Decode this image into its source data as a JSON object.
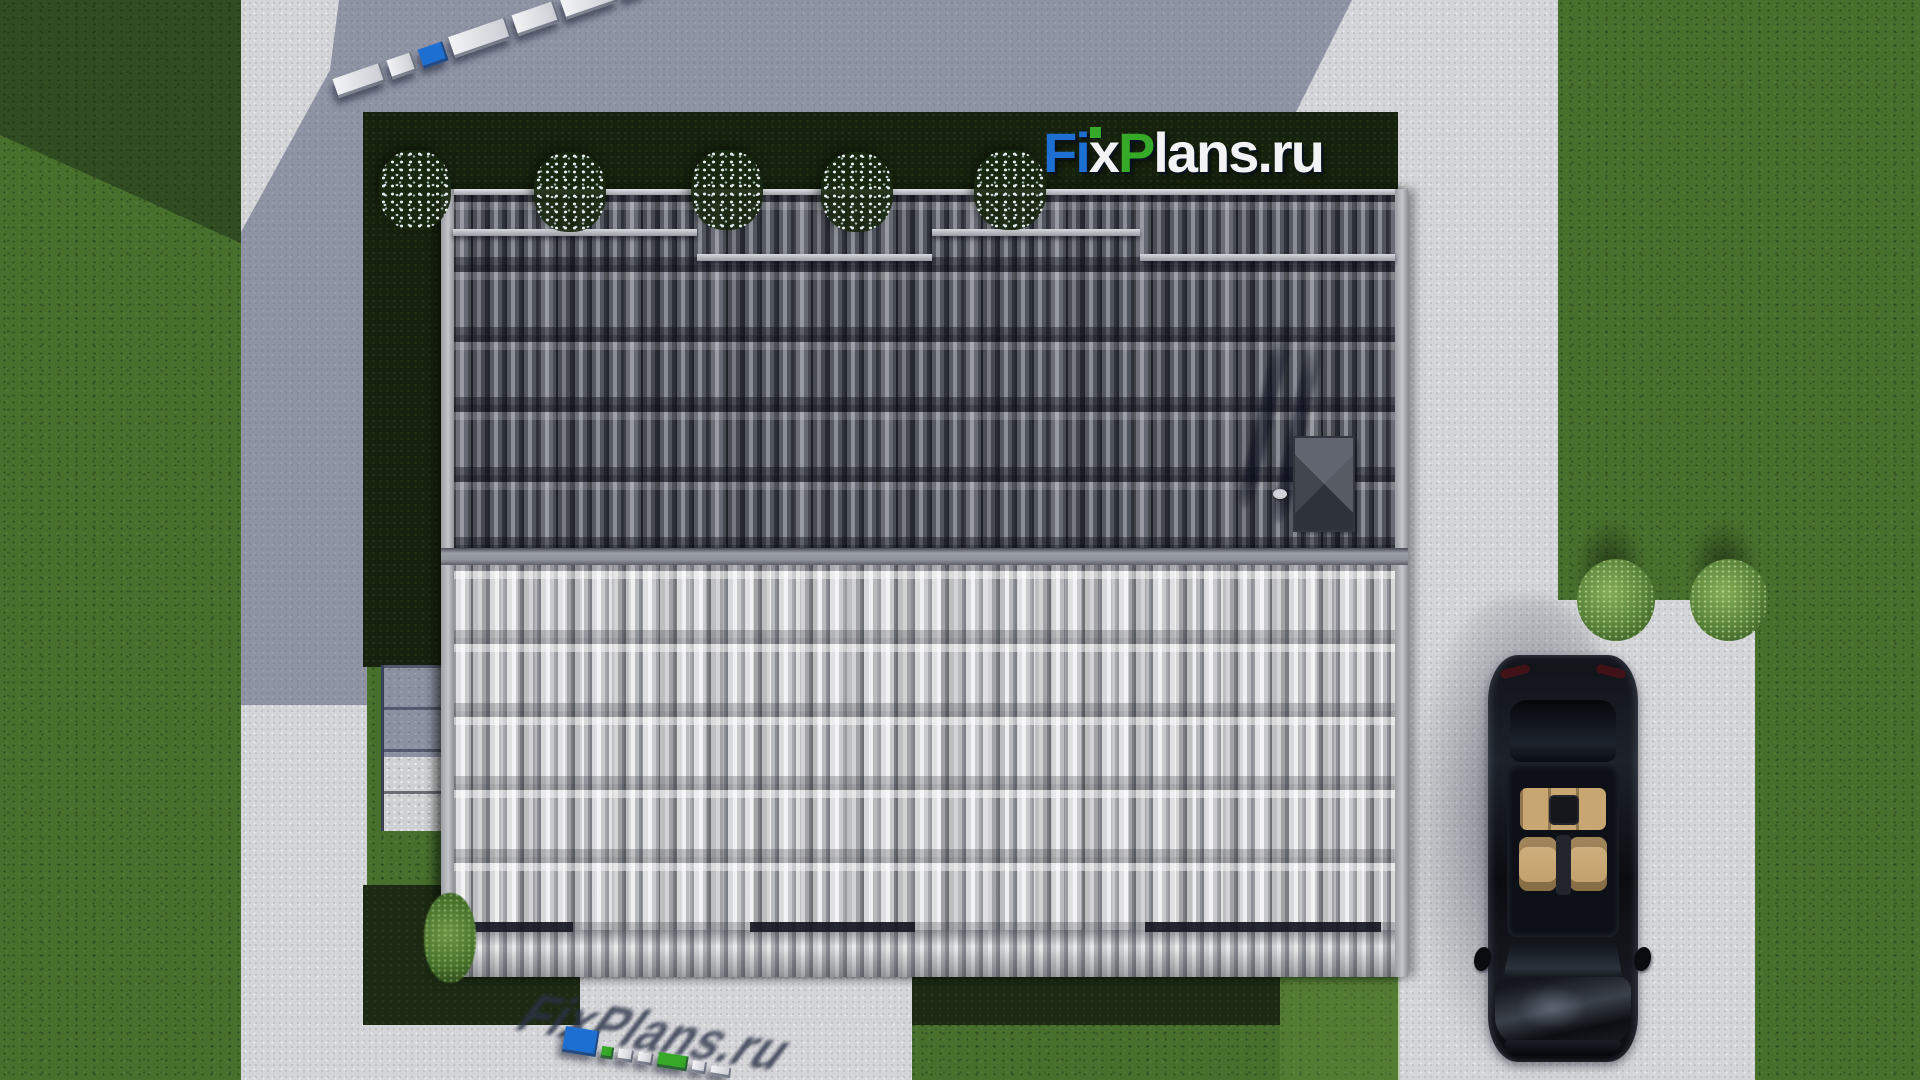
{
  "site": {
    "brand": "FixPlans.ru"
  },
  "logo": {
    "segments": [
      {
        "text": "F",
        "color": "#1e6fd2"
      },
      {
        "text": "i",
        "color": "#1e6fd2"
      },
      {
        "text": "x",
        "color": "#f2f3f5"
      },
      {
        "text": "P",
        "color": "#36a928"
      },
      {
        "text": "lans",
        "color": "#f2f3f5"
      },
      {
        "text": ".ru",
        "color": "#f2f3f5"
      }
    ],
    "i_dot_color": "#36a928"
  },
  "palette": {
    "grass": "#47702d",
    "concrete": "#d4d5d8",
    "concrete_shadow": "rgba(58,68,102,0.45)",
    "hedge": "#17220e",
    "roof_dark": "#4a4e57",
    "roof_light": "#cdced2",
    "ridge": "#8f9399",
    "fascia": "#b2b5ba",
    "car": "#0c0e12",
    "car_interior": "#c9a872",
    "logo_blue": "#1e6fd2",
    "logo_green": "#36a928",
    "logo_white": "#f2f3f5"
  },
  "watermarks": {
    "top_strip": {
      "angle_deg": -19,
      "blocks": [
        {
          "c": "white",
          "w": 50,
          "h": 20
        },
        {
          "c": "white",
          "w": 26,
          "h": 20
        },
        {
          "c": "blue",
          "w": 26,
          "h": 20
        },
        {
          "c": "white",
          "w": 60,
          "h": 22
        },
        {
          "c": "white",
          "w": 44,
          "h": 22
        },
        {
          "c": "white",
          "w": 54,
          "h": 22
        },
        {
          "c": "white",
          "w": 22,
          "h": 20
        },
        {
          "c": "green",
          "w": 56,
          "h": 24
        },
        {
          "c": "white",
          "w": 40,
          "h": 22
        },
        {
          "c": "green",
          "w": 18,
          "h": 18
        },
        {
          "c": "blue",
          "w": 52,
          "h": 34
        }
      ]
    },
    "bottom_strip": {
      "angle_deg": 9,
      "shadow_text": "FixPlans.ru",
      "blocks": [
        {
          "c": "blue",
          "w": 34,
          "h": 26
        },
        {
          "c": "green",
          "w": 12,
          "h": 12
        },
        {
          "c": "white",
          "w": 15,
          "h": 12
        },
        {
          "c": "white",
          "w": 15,
          "h": 12
        },
        {
          "c": "green",
          "w": 30,
          "h": 15
        },
        {
          "c": "white",
          "w": 14,
          "h": 12
        },
        {
          "c": "white",
          "w": 20,
          "h": 10
        }
      ]
    }
  },
  "scene": {
    "hedge_flower_bushes": [
      {
        "x": 379,
        "y": 150
      },
      {
        "x": 534,
        "y": 152
      },
      {
        "x": 691,
        "y": 150
      },
      {
        "x": 821,
        "y": 152
      },
      {
        "x": 974,
        "y": 150
      }
    ],
    "lawn_round_bushes": [
      {
        "x": 1573,
        "y": 517
      },
      {
        "x": 1686,
        "y": 517
      }
    ],
    "roof_gutter_bars": [
      {
        "x": 453,
        "y": 229,
        "w": 244
      },
      {
        "x": 697,
        "y": 254,
        "w": 235
      },
      {
        "x": 932,
        "y": 229,
        "w": 208
      },
      {
        "x": 1140,
        "y": 254,
        "w": 255
      }
    ],
    "eave_dark_segments": [
      {
        "x": 463,
        "y": 922,
        "w": 110
      },
      {
        "x": 750,
        "y": 922,
        "w": 165
      },
      {
        "x": 1145,
        "y": 922,
        "w": 236
      }
    ]
  }
}
